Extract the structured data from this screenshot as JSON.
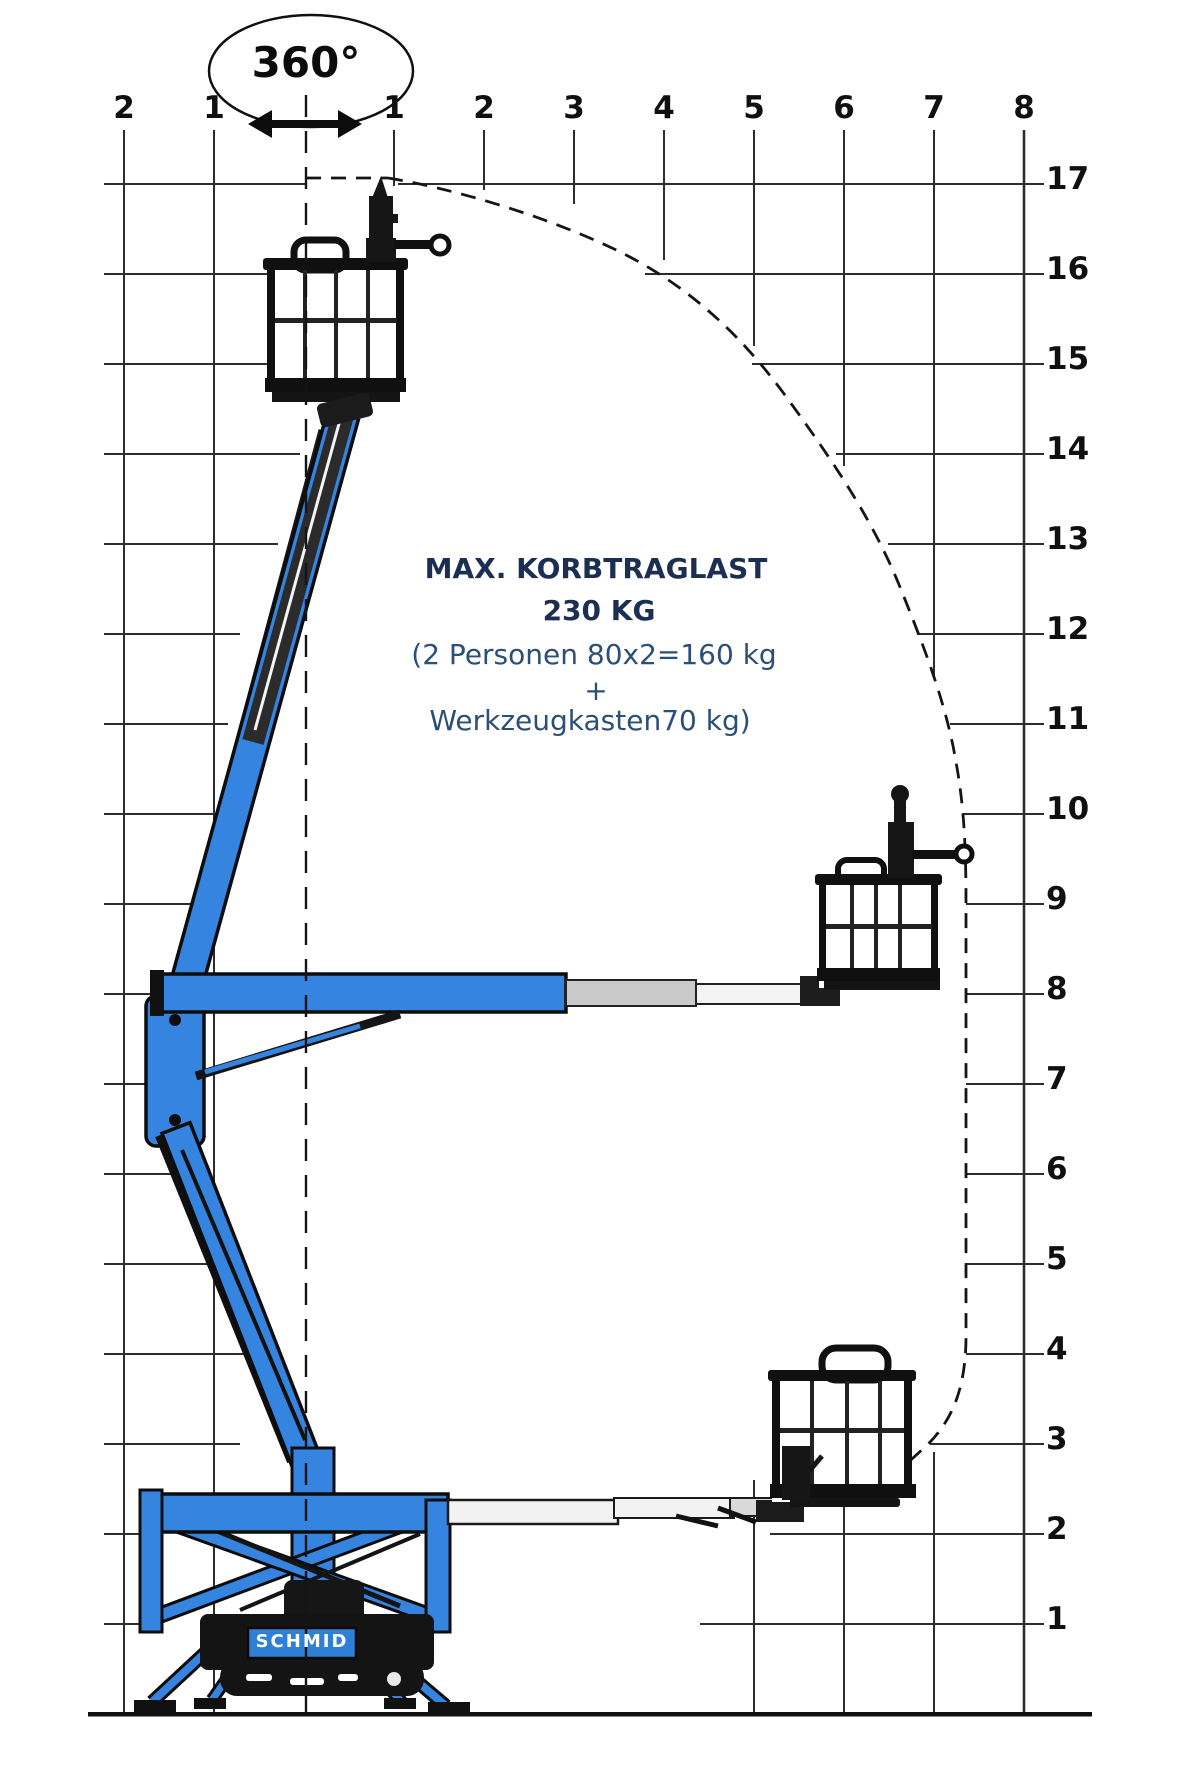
{
  "rotation": {
    "label": "360°"
  },
  "load_text": {
    "line1": "MAX. KORBTRAGLAST",
    "line2": "230 KG",
    "line3": "(2 Personen 80x2=160 kg",
    "line4": "+",
    "line5": "Werkzeugkasten70 kg)"
  },
  "brand": {
    "name": "SCHMID"
  },
  "axes": {
    "x": [
      "2",
      "1",
      "1",
      "2",
      "3",
      "4",
      "5",
      "6",
      "7",
      "8"
    ],
    "y": [
      "17",
      "16",
      "15",
      "14",
      "13",
      "12",
      "11",
      "10",
      "9",
      "8",
      "7",
      "6",
      "5",
      "4",
      "3",
      "2",
      "1"
    ]
  },
  "colors": {
    "machine_blue": "#3584e0",
    "brand_panel_blue": "#2f7fd6",
    "title_navy": "#1c2f52",
    "body_text_blue": "#2c4f76",
    "line_color": "#1a1a1a"
  }
}
